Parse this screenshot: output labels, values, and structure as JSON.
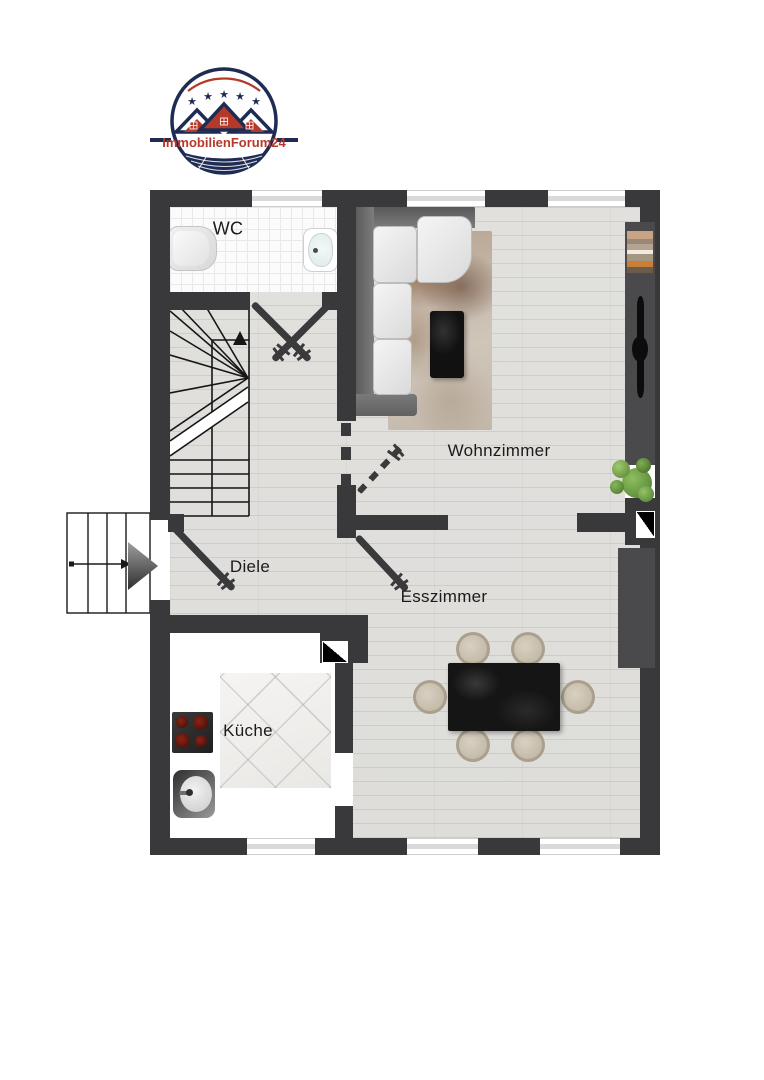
{
  "logo": {
    "brand": "ImmobilienForum24",
    "star_count": "5"
  },
  "rooms": {
    "wc": {
      "label": "WC"
    },
    "diele": {
      "label": "Diele"
    },
    "wohnzimmer": {
      "label": "Wohnzimmer"
    },
    "esszimmer": {
      "label": "Esszimmer"
    },
    "kueche": {
      "label": "Küche"
    }
  },
  "colors": {
    "wall": "#39393b",
    "floor_wood": "#e0dfdc",
    "wc_tile": "#fbfbfb",
    "kitchen_counter": "#ffffff",
    "brand_red": "#b5392a",
    "brand_navy": "#1e2b53",
    "sideboard_gray": "#4a4a4c",
    "label_text": "#1b1b1b",
    "plant_green": "#6a9c43"
  },
  "icons": {
    "sofa": "corner-sofa-top-view",
    "coffee_table": "black-marble-table",
    "rug": "area-rug",
    "tv": "flatscreen-tv-top-view",
    "books": "book-stack",
    "plant": "potted-plant",
    "dining_table": "dining-table-6-seats",
    "toilet": "toilet-top-view",
    "washbasin": "washbasin",
    "cooktop": "cooktop-4-burners",
    "kitchen_sink": "round-sink",
    "stairs": "winder-staircase",
    "entrance_arrow": "entrance-direction-arrow",
    "chimney": "chimney-shaft-symbol"
  }
}
